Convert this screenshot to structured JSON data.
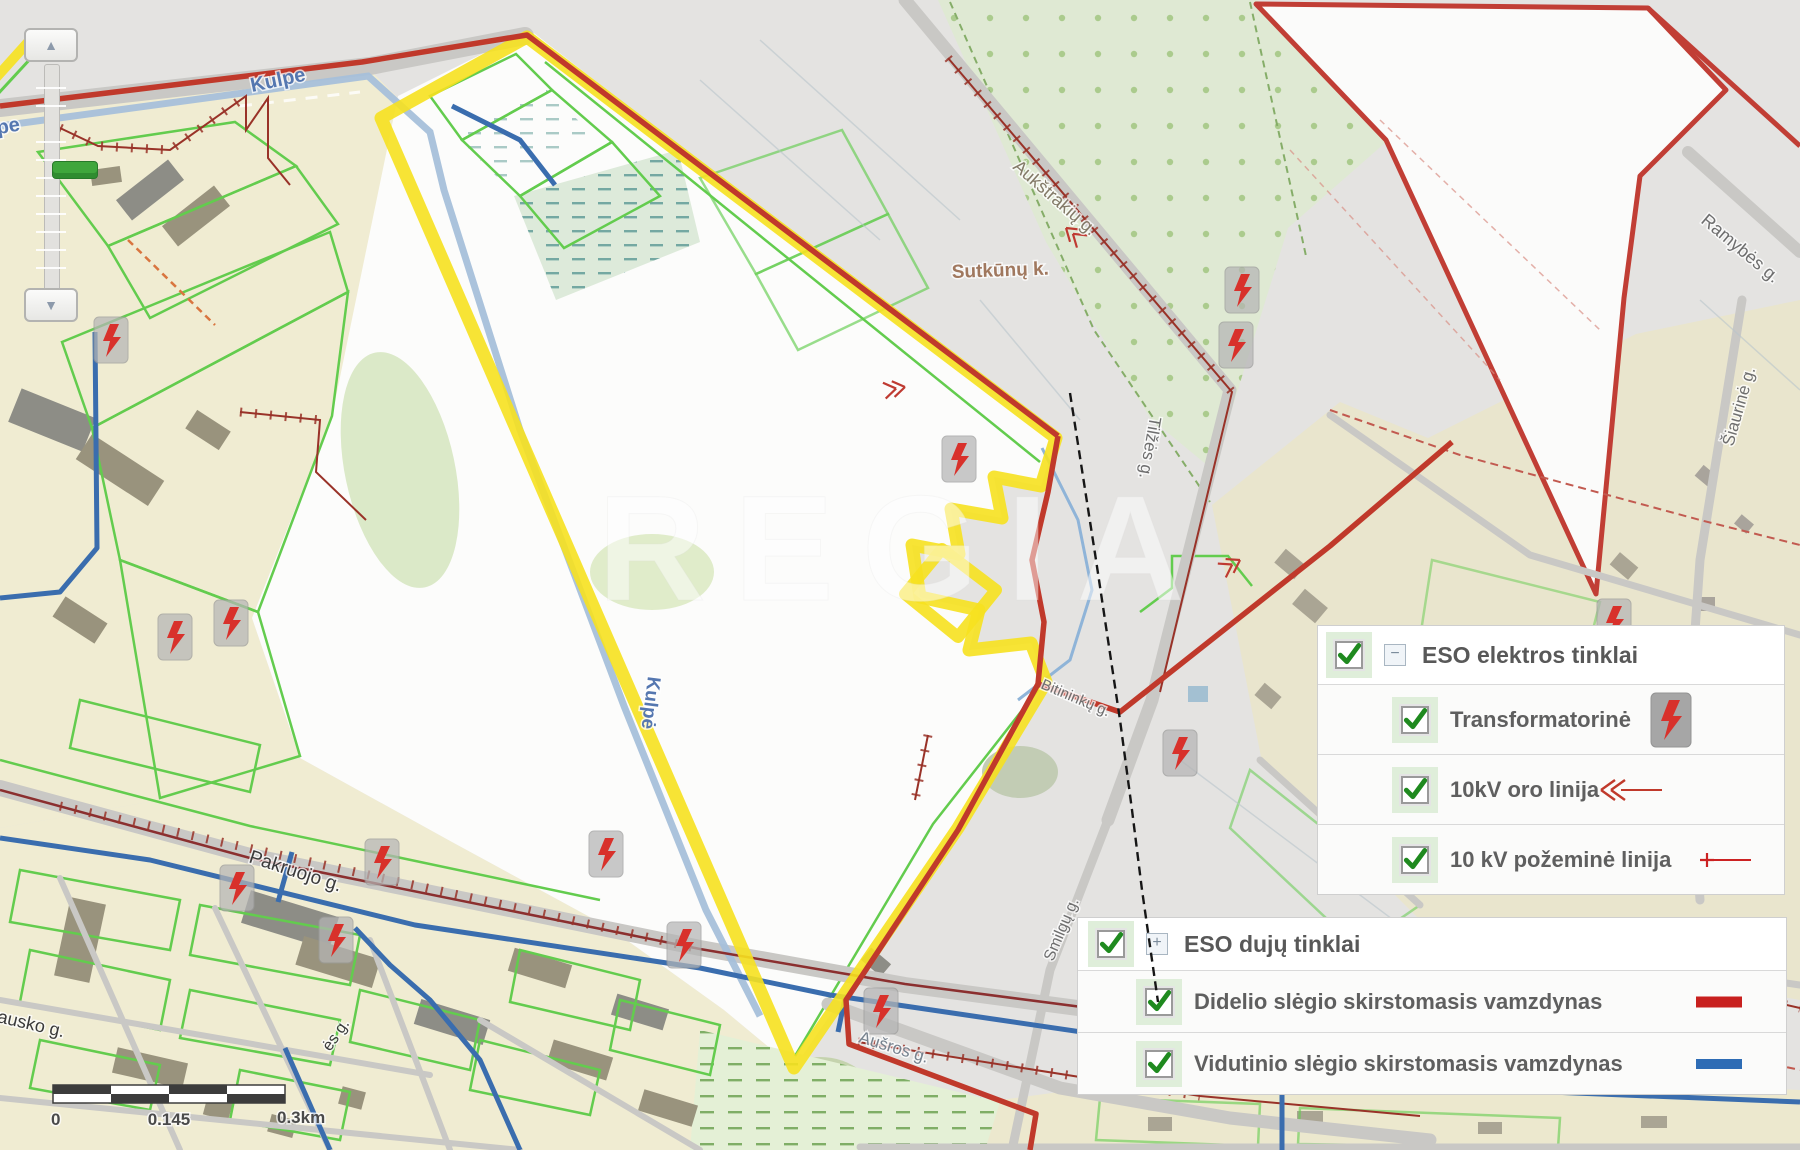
{
  "app": {
    "watermark": "REGIA"
  },
  "zoom_control": {
    "zoom_in_icon": "▲",
    "zoom_out_icon": "▼"
  },
  "scale_bar": {
    "start": "0",
    "mid": "0.145",
    "end": "0.3km"
  },
  "legends": {
    "elektros": {
      "title": "ESO elektros tinklai",
      "expand_icon": "−",
      "checked": true,
      "items": [
        {
          "label": "Transformatorinė",
          "icon": "transformer-icon",
          "checked": true
        },
        {
          "label": "10kV oro linija",
          "icon": "overhead-line-icon",
          "checked": true
        },
        {
          "label": "10 kV požeminė linija",
          "icon": "underground-line-icon",
          "checked": true
        }
      ]
    },
    "dujos": {
      "title": "ESO dujų tinklai",
      "expand_icon": "+",
      "checked": true,
      "items": [
        {
          "label": "Didelio slėgio skirstomasis vamzdynas",
          "color": "#c8201e",
          "checked": true
        },
        {
          "label": "Vidutinio slėgio skirstomasis vamzdynas",
          "color": "#2e6cb5",
          "checked": true
        }
      ]
    }
  },
  "map": {
    "colors": {
      "highlight_boundary": "#f6e11f",
      "gas_high_pressure": "#c0392b",
      "gas_medium_pressure": "#3a6dae",
      "power_10kv_line": "#993228",
      "transformer_bolt": "#d8312b"
    },
    "street_labels": [
      {
        "text": "Kulpe"
      },
      {
        "text": "Kulpe"
      },
      {
        "text": "Kulpė"
      },
      {
        "text": "Pakruojo g."
      },
      {
        "text": "Aukštrakių g."
      },
      {
        "text": "Sutkūnų k."
      },
      {
        "text": "Tilžės g."
      },
      {
        "text": "Ramybės g."
      },
      {
        "text": "Šiaurinė g."
      },
      {
        "text": "Smilgų g."
      },
      {
        "text": "Aušros g."
      },
      {
        "text": "kausko g."
      },
      {
        "text": "ės g."
      },
      {
        "text": "Bitininkų g."
      }
    ]
  }
}
